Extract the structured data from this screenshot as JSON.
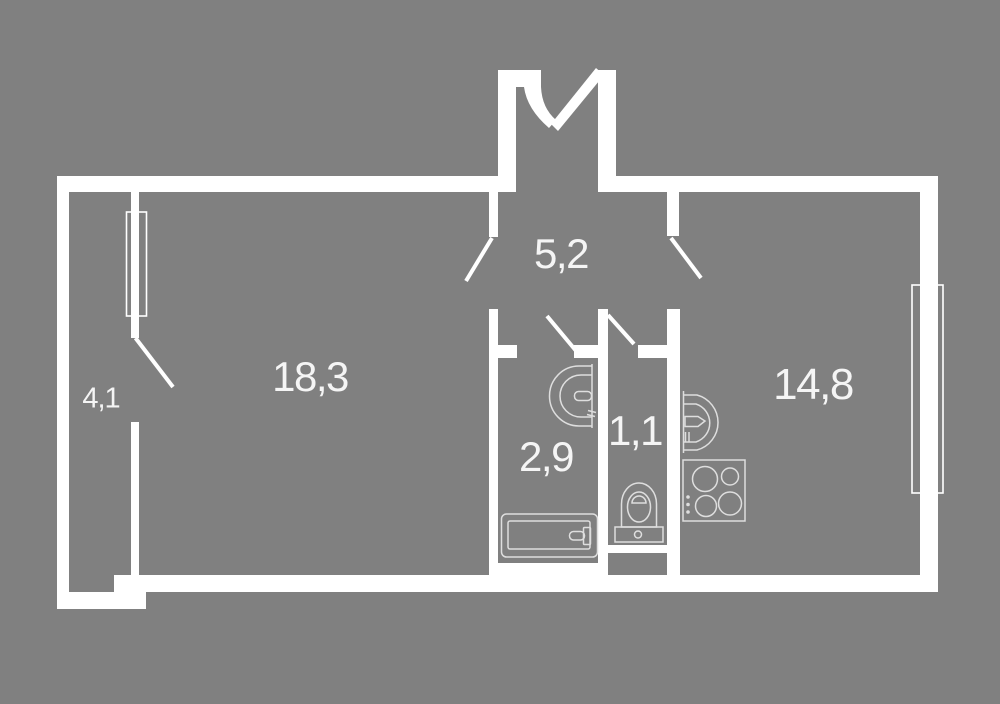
{
  "plan": {
    "type": "apartment floor plan",
    "colors": {
      "bg": "#808080",
      "wall": "#ffffff",
      "line": "#dedede",
      "label": "#f5f5f5"
    },
    "rooms": [
      {
        "name": "hallway-small",
        "label": "4,1"
      },
      {
        "name": "living-room",
        "label": "18,3"
      },
      {
        "name": "entrance-hall",
        "label": "5,2"
      },
      {
        "name": "bathroom",
        "label": "2,9"
      },
      {
        "name": "wc",
        "label": "1,1"
      },
      {
        "name": "kitchen",
        "label": "14,8"
      }
    ],
    "fixtures": [
      "entrance-door",
      "door-swing",
      "window",
      "bathtub",
      "bathroom-sink",
      "toilet",
      "kitchen-sink",
      "stove"
    ]
  }
}
